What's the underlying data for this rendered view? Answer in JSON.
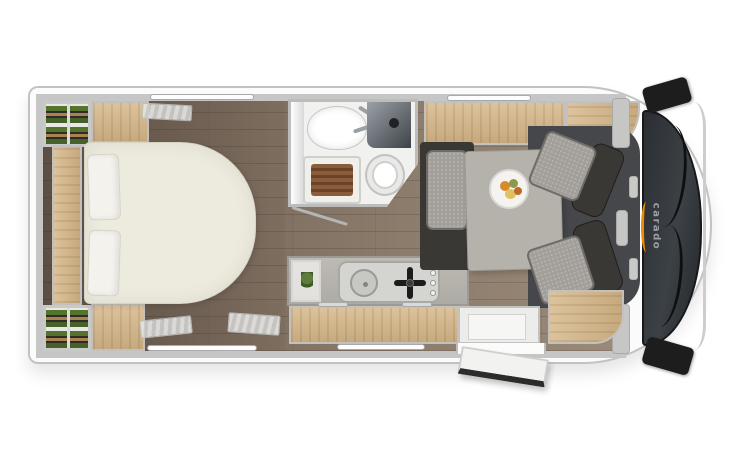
{
  "brand": {
    "logo_text": "carado",
    "accent_color": "#F08A00"
  },
  "palette": {
    "body": "#fbfbfb",
    "wall": "#c6c6c6",
    "floor_a": "#6e6053",
    "floor_b": "#9b8a78",
    "wood_a": "#dcc39c",
    "wood_b": "#c6a97e",
    "bed": "#edeade",
    "cushion": "#a29e99",
    "dark_frame": "#3a3835",
    "table": "#b5b2ac",
    "windshield_a": "#2b2f33",
    "windshield_b": "#3c4146",
    "cab_floor": "#45474a",
    "slat_a": "#8a5c39",
    "slat_b": "#6b4428",
    "item_green": "#54742e",
    "item_tan": "#a8824f",
    "logo_text": "#9ba0a5",
    "accent": "#F08A00"
  }
}
